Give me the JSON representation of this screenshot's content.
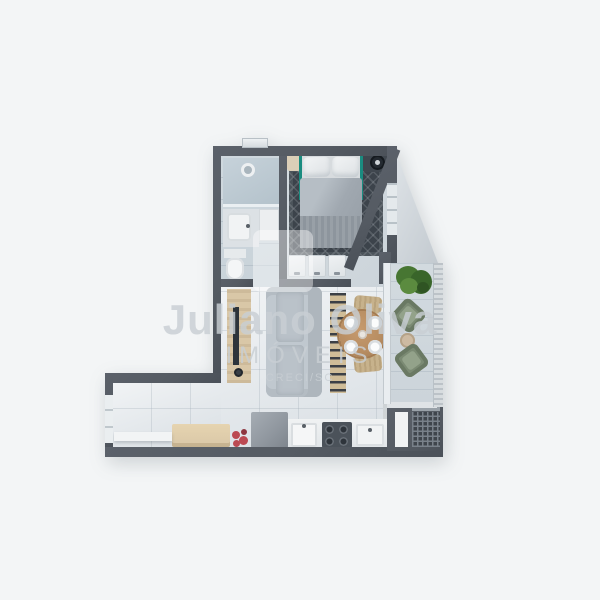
{
  "page": {
    "background": "#f3f5f6",
    "description": "Top-down 3D rendered floor plan of a one-bedroom apartment with balcony"
  },
  "watermark": {
    "brand": "Juliano Oliva",
    "subtitle": "IMÓVEIS",
    "license": "CRECI/SC"
  },
  "palette": {
    "page_bg": "#f3f5f6",
    "wall": "#555b63",
    "wall_dark": "#4b5159",
    "floor_light": "#e0e5e9",
    "floor_cool": "#c8d2d9",
    "floor_balcony": "#ccd4da",
    "rug": "#3c434b",
    "teal": "#1a8c80",
    "duvet": "#a0a8b0",
    "sofa": "#c0c8cf",
    "wood_light": "#d9c7a7",
    "wood_slat": "#d0bd98",
    "wood_table": "#b78d62",
    "chair_rattan": "#c7b28c",
    "chair_green": "#7b8a73",
    "plant": "#477632",
    "flower": "#bb4a53",
    "appliance": "#4b525a",
    "fridge": "#8f969e",
    "white_fixture": "#f1f3f5",
    "railing": "#d7dcdf",
    "watermark_text": "#c9cfd4"
  },
  "rooms": {
    "bathroom": {
      "items": [
        "shower",
        "shower-drain",
        "vanity-sink",
        "toilet"
      ]
    },
    "bedroom": {
      "items": [
        "double-bed",
        "teal-headboard",
        "pillows",
        "patterned-rug",
        "nightstand-left",
        "nightstand-right",
        "table-lamp",
        "wardrobe-3-doors",
        "window"
      ]
    },
    "living_dining": {
      "items": [
        "tv-panel",
        "tv",
        "sofa",
        "slatted-console",
        "round-dining-table",
        "four-plates",
        "rattan-chairs",
        "glass-door-to-balcony"
      ]
    },
    "balcony": {
      "items": [
        "potted-plant",
        "green-armchair",
        "green-armchair",
        "round-side-table",
        "railing"
      ]
    },
    "kitchen_wing": {
      "items": [
        "white-shelf",
        "wood-bench",
        "red-flowers",
        "refrigerator",
        "sink",
        "four-burner-cooktop",
        "counter",
        "window"
      ]
    },
    "service_area": {
      "items": [
        "door",
        "drying-grid",
        "taps"
      ]
    }
  }
}
